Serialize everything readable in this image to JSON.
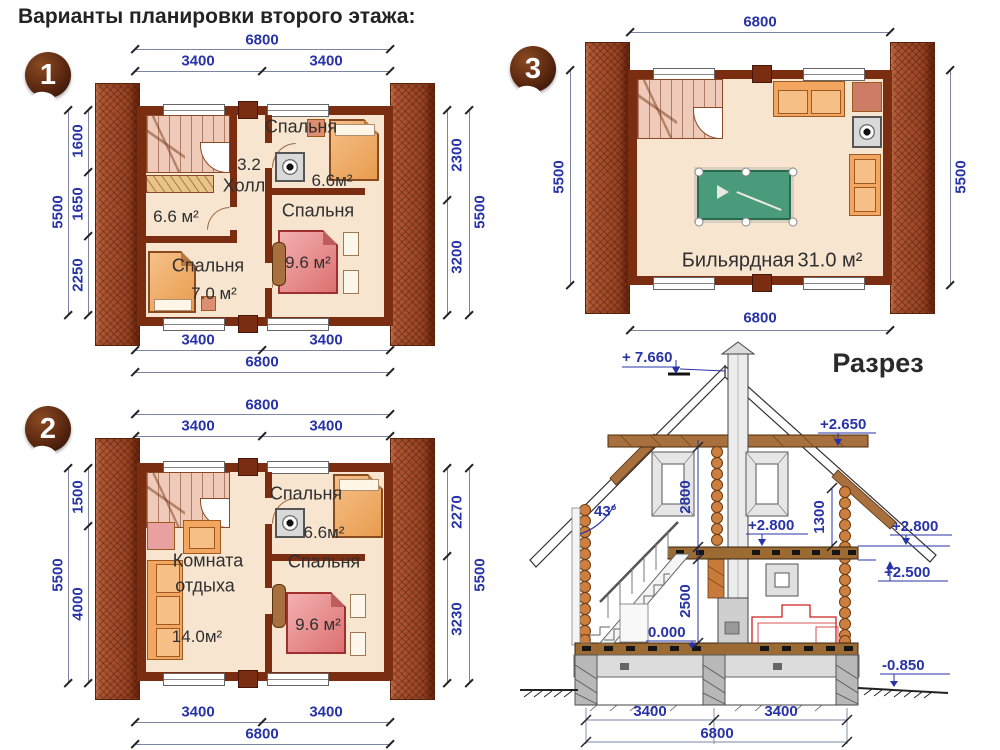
{
  "title": "Варианты планировки второго этажа:",
  "colors": {
    "dim_blue": "#2733a6",
    "wall_brown": "#7b2d12",
    "brick": "#9a4a2e",
    "floor_cream": "#f7e5d0",
    "bed_pink": "#dd7070",
    "pool_green": "#4a9a7c"
  },
  "plans": [
    {
      "number": "1",
      "dims": {
        "top_total": "6800",
        "top_left": "3400",
        "top_right": "3400",
        "left_total": "5500",
        "left_segs": [
          "1600",
          "1650",
          "2250"
        ],
        "right_total": "5500",
        "right_segs": [
          "2300",
          "3200"
        ],
        "bottom_left": "3400",
        "bottom_right": "3400",
        "bottom_total": "6800"
      },
      "rooms": {
        "bedroom_top_name": "Спальня",
        "bedroom_top_area": "6.6м²",
        "hall_area": "3.2",
        "hall_name": "Холл",
        "room_mid_area": "6.6 м²",
        "bedroom_left_name": "Спальня",
        "bedroom_left_area": "7.0 м²",
        "bedroom_right_name": "Спальня",
        "bedroom_right_area": "9.6 м²"
      }
    },
    {
      "number": "2",
      "dims": {
        "top_total": "6800",
        "top_left": "3400",
        "top_right": "3400",
        "left_total": "5500",
        "left_segs": [
          "1500",
          "4000"
        ],
        "right_total": "5500",
        "right_segs": [
          "2270",
          "3230"
        ],
        "bottom_left": "3400",
        "bottom_right": "3400",
        "bottom_total": "6800"
      },
      "rooms": {
        "bedroom_top_name": "Спальня",
        "bedroom_top_area": "6.6м²",
        "lounge_name_line1": "Комната",
        "lounge_name_line2": "отдыха",
        "lounge_area": "14.0м²",
        "bedroom_right_name": "Спальня",
        "bedroom_right_area": "9.6 м²"
      }
    },
    {
      "number": "3",
      "dims": {
        "top_total": "6800",
        "left_total": "5500",
        "right_total": "5500",
        "bottom_total": "6800"
      },
      "rooms": {
        "billiard_name": "Бильярдная",
        "billiard_area": "31.0 м²"
      }
    }
  ],
  "section_view": {
    "title": "Разрез",
    "levels": {
      "peak": "+ 7.660",
      "collar": "+2.650",
      "attic_left": "+2.800",
      "attic_right": "+2.800",
      "eaves": "+2.500",
      "ground": "0.000",
      "basement": "-0.850"
    },
    "dims": {
      "attic_height": "2800",
      "knee_wall": "1300",
      "floor_height": "2500",
      "roof_angle": "43°",
      "bottom_left": "3400",
      "bottom_right": "3400",
      "bottom_total": "6800"
    }
  }
}
